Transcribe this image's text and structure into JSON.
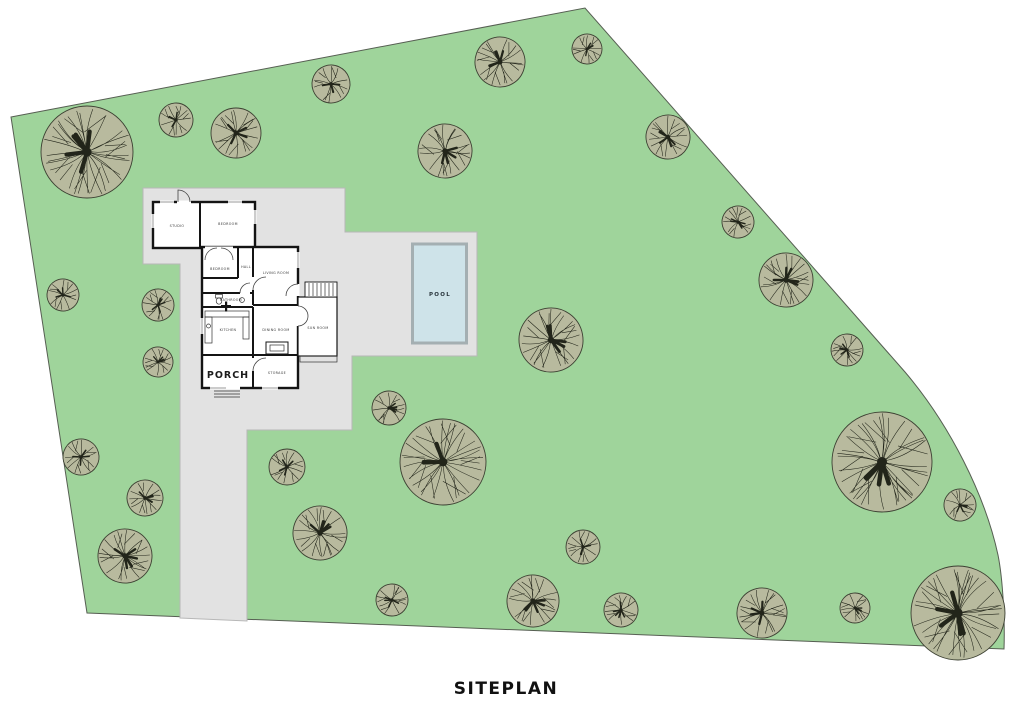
{
  "title": "SITEPLAN",
  "pool_label": "POOL",
  "rooms": {
    "studio": "STUDIO",
    "bedroom1": "BEDROOM",
    "bedroom2": "BEDROOM",
    "hall": "HALL",
    "living": "LIVING ROOM",
    "bathroom": "BATHROOM",
    "kitchen": "KITCHEN",
    "dining": "DINING ROOM",
    "sunroom": "SUN ROOM",
    "porch": "PORCH",
    "storage": "STORAGE"
  },
  "colors": {
    "grass": "#9fd49b",
    "grass_outline": "#565e52",
    "hardscape": "#e2e2e2",
    "hardscape_outline": "#b7b7b7",
    "wall": "#141414",
    "tree_fill": "#b8ba9e",
    "tree_outline": "#3c4032",
    "branch": "#22251a",
    "pool_water": "#cee3e9",
    "pool_border": "#a4afb2"
  },
  "trees": [
    {
      "x": 87,
      "y": 152,
      "r": 46,
      "rot": 0
    },
    {
      "x": 176,
      "y": 120,
      "r": 17,
      "rot": 40
    },
    {
      "x": 236,
      "y": 133,
      "r": 25,
      "rot": 90
    },
    {
      "x": 331,
      "y": 84,
      "r": 19,
      "rot": 160
    },
    {
      "x": 445,
      "y": 151,
      "r": 27,
      "rot": 20
    },
    {
      "x": 500,
      "y": 62,
      "r": 25,
      "rot": 200
    },
    {
      "x": 587,
      "y": 49,
      "r": 15,
      "rot": 70
    },
    {
      "x": 668,
      "y": 137,
      "r": 22,
      "rot": 120
    },
    {
      "x": 738,
      "y": 222,
      "r": 16,
      "rot": 300
    },
    {
      "x": 786,
      "y": 280,
      "r": 27,
      "rot": 10
    },
    {
      "x": 847,
      "y": 350,
      "r": 16,
      "rot": 220
    },
    {
      "x": 551,
      "y": 340,
      "r": 32,
      "rot": 80
    },
    {
      "x": 63,
      "y": 295,
      "r": 16,
      "rot": 150
    },
    {
      "x": 158,
      "y": 305,
      "r": 16,
      "rot": 260
    },
    {
      "x": 158,
      "y": 362,
      "r": 15,
      "rot": 330
    },
    {
      "x": 81,
      "y": 457,
      "r": 18,
      "rot": 30
    },
    {
      "x": 145,
      "y": 498,
      "r": 18,
      "rot": 110
    },
    {
      "x": 125,
      "y": 556,
      "r": 27,
      "rot": 190
    },
    {
      "x": 287,
      "y": 467,
      "r": 18,
      "rot": 270
    },
    {
      "x": 320,
      "y": 533,
      "r": 27,
      "rot": 60
    },
    {
      "x": 389,
      "y": 408,
      "r": 17,
      "rot": 140
    },
    {
      "x": 443,
      "y": 462,
      "r": 43,
      "rot": 230
    },
    {
      "x": 392,
      "y": 600,
      "r": 16,
      "rot": 310
    },
    {
      "x": 533,
      "y": 601,
      "r": 26,
      "rot": 100
    },
    {
      "x": 583,
      "y": 547,
      "r": 17,
      "rot": 180
    },
    {
      "x": 621,
      "y": 610,
      "r": 17,
      "rot": 250
    },
    {
      "x": 762,
      "y": 613,
      "r": 25,
      "rot": 20
    },
    {
      "x": 855,
      "y": 608,
      "r": 15,
      "rot": 130
    },
    {
      "x": 882,
      "y": 462,
      "r": 50,
      "rot": 290
    },
    {
      "x": 958,
      "y": 613,
      "r": 47,
      "rot": 45
    },
    {
      "x": 960,
      "y": 505,
      "r": 16,
      "rot": 350
    }
  ]
}
